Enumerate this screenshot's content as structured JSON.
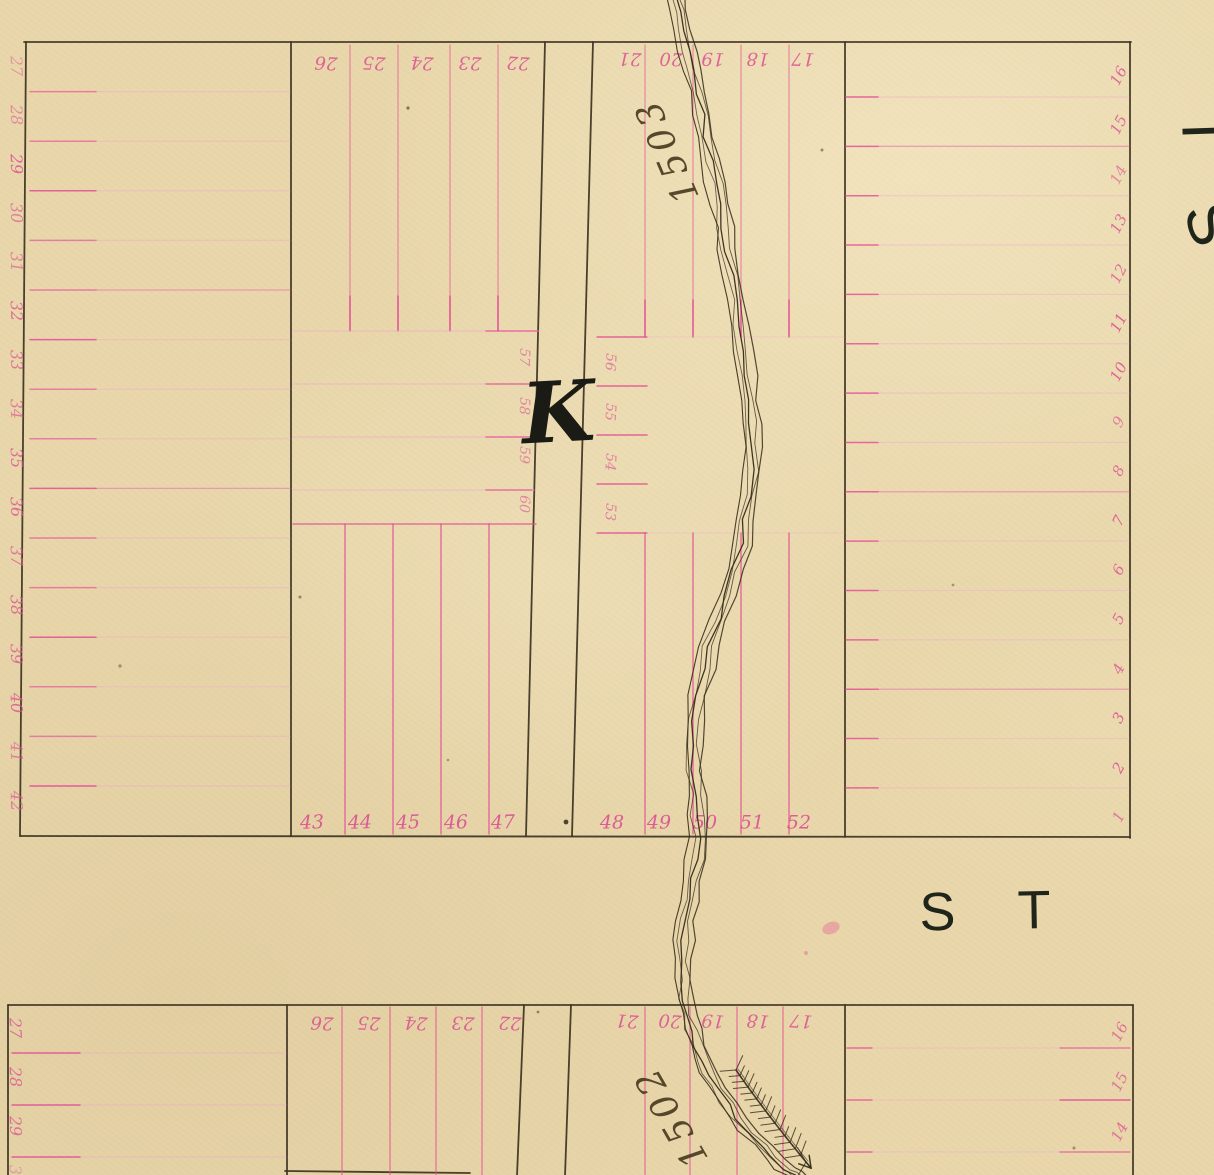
{
  "map": {
    "block_letter": "K",
    "street_label": "S T",
    "side_street_letters": [
      "T",
      "S"
    ],
    "survey_labels": {
      "upper": "1503",
      "lower": "1502"
    },
    "top_block": {
      "left_edge_lots": [
        "27",
        "28",
        "29",
        "30",
        "31",
        "32",
        "33",
        "34",
        "35",
        "36",
        "37",
        "38",
        "39",
        "40",
        "41",
        "42"
      ],
      "top_row_lots_left": [
        "26",
        "25",
        "24",
        "23",
        "22"
      ],
      "top_row_lots_right": [
        "21",
        "20",
        "19",
        "18",
        "17"
      ],
      "interior_lots_left": [
        "57",
        "58",
        "59",
        "60"
      ],
      "interior_lots_right": [
        "56",
        "55",
        "54",
        "53"
      ],
      "bottom_row_lots_left": [
        "43",
        "44",
        "45",
        "46",
        "47"
      ],
      "bottom_row_lots_right": [
        "48",
        "49",
        "50",
        "51",
        "52"
      ],
      "right_edge_lots": [
        "16",
        "15",
        "14",
        "13",
        "12",
        "11",
        "10",
        "9",
        "8",
        "7",
        "6",
        "5",
        "4",
        "3",
        "2",
        "1"
      ]
    },
    "bottom_block": {
      "left_edge_lots": [
        "27",
        "28",
        "29",
        "30"
      ],
      "top_row_lots_left": [
        "26",
        "25",
        "24",
        "23",
        "22"
      ],
      "top_row_lots_right": [
        "21",
        "20",
        "19",
        "18",
        "17"
      ],
      "right_edge_lots": [
        "16",
        "15",
        "14"
      ]
    },
    "colors": {
      "paper": "#e9d7ab",
      "ink": "#3c3222",
      "pink_bright": "#e44f93",
      "pink_faint": "#edafc5",
      "letters": "#20251b"
    }
  }
}
